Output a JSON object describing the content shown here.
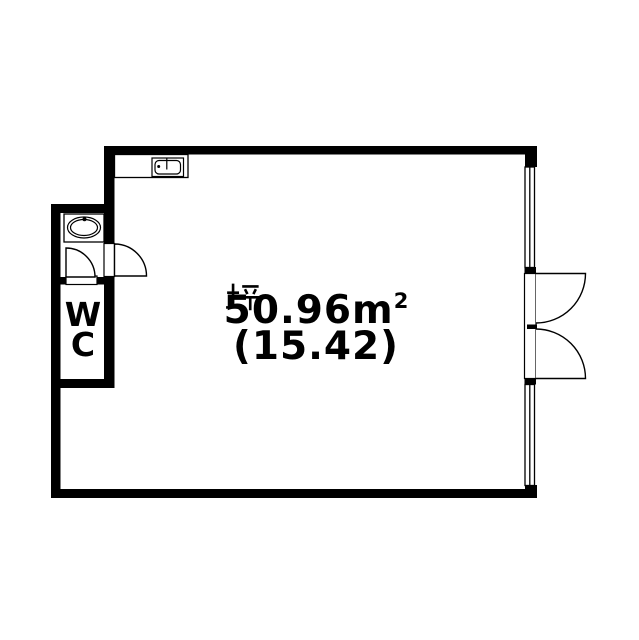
{
  "plan": {
    "area_label": {
      "m2_value": "50.96",
      "m2_unit": "m",
      "m2_sup": "2",
      "tsubo_prefix": "(15.42",
      "tsubo_kanji": "坪",
      "tsubo_suffix": ")"
    },
    "wc_label": {
      "line1": "W",
      "line2": "C"
    },
    "colors": {
      "wall": "#000000",
      "line": "#000000",
      "floor": "#ffffff"
    },
    "icons": {
      "kitchen_sink": "kitchen-sink-icon",
      "wash_basin": "wash-basin-icon",
      "entry_door": "door-swing-icon",
      "wc_door": "door-swing-icon",
      "double_door": "double-door-swing-icon",
      "window_upper": "window-icon",
      "window_lower": "window-icon"
    }
  }
}
